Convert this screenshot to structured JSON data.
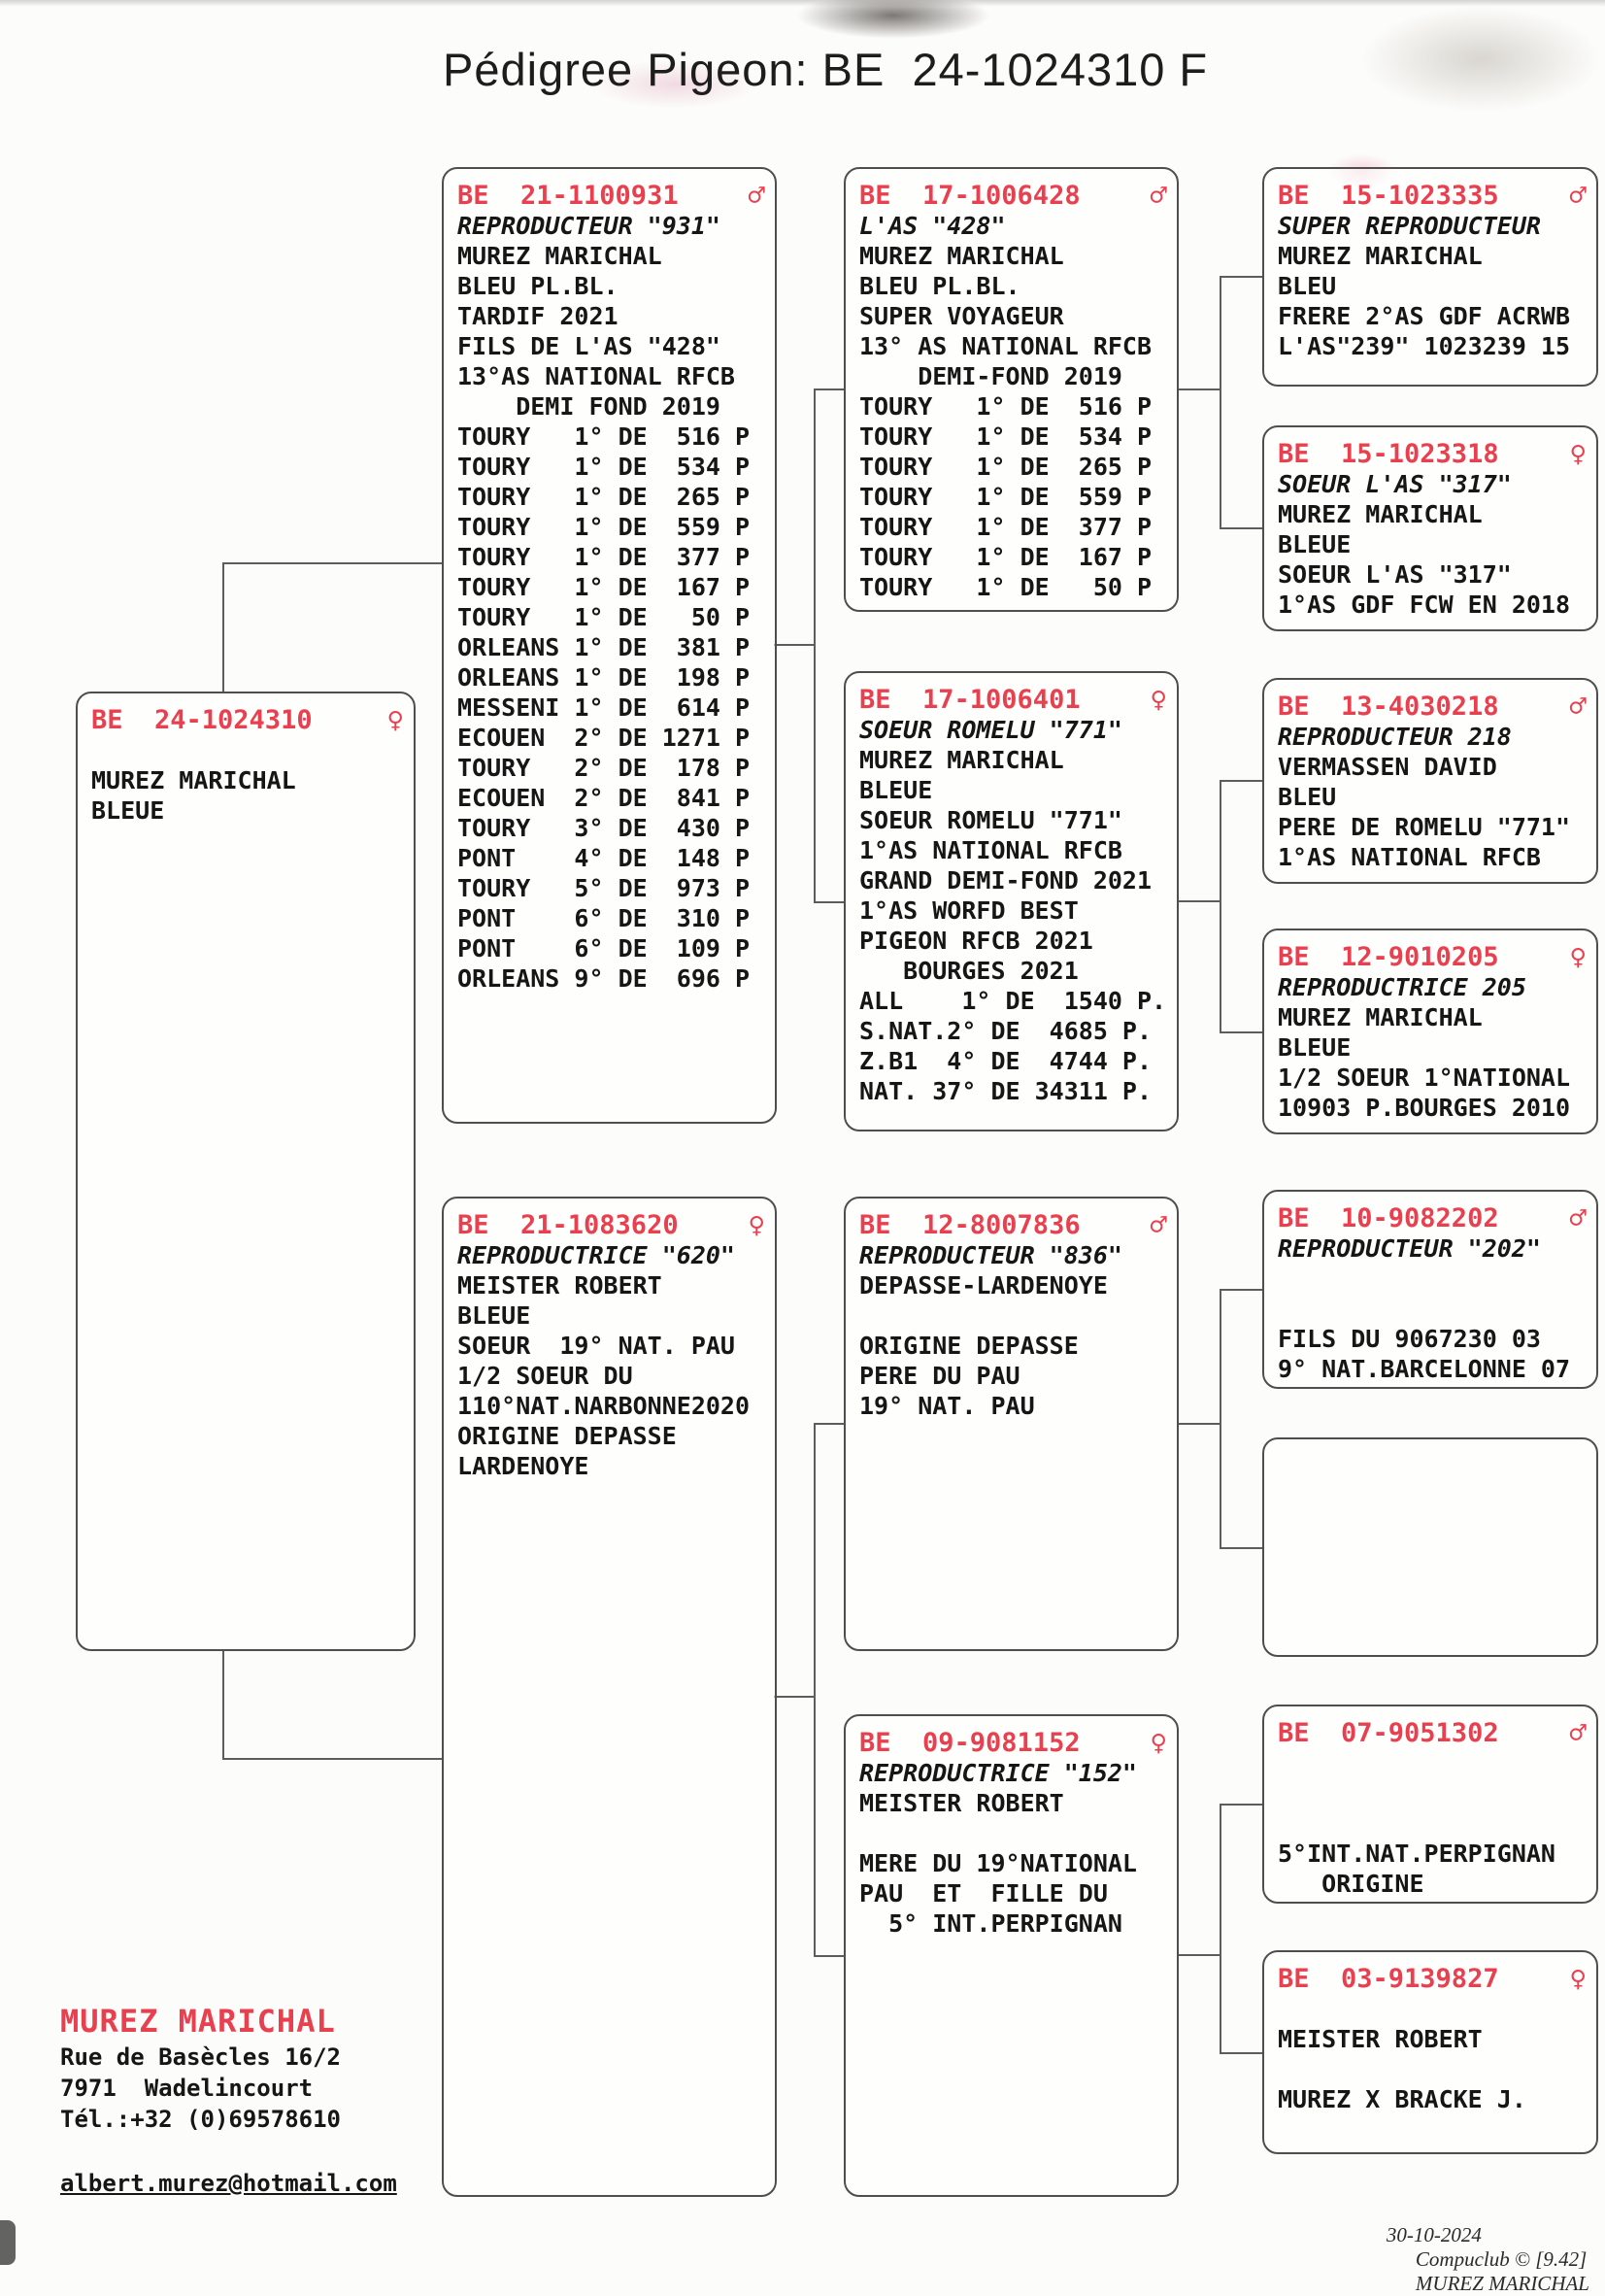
{
  "title": "Pédigree Pigeon: BE  24-1024310 F",
  "colors": {
    "accent_red": "#e9404f",
    "text": "#161616",
    "box_border": "#4e4e4e"
  },
  "boxes": {
    "subject": {
      "ring": "BE  24-1024310",
      "sex": "female",
      "sex_symbol": "♀",
      "lines": [
        "",
        "MUREZ MARICHAL",
        "BLEUE"
      ]
    },
    "sire": {
      "ring": "BE  21-1100931",
      "sex": "male",
      "sex_symbol": "♂",
      "name": "REPRODUCTEUR \"931\"",
      "lines": [
        "MUREZ MARICHAL",
        "BLEU PL.BL.",
        "TARDIF 2021",
        "FILS DE L'AS \"428\"",
        "13°AS NATIONAL RFCB",
        "    DEMI FOND 2019",
        "TOURY   1° DE  516 P",
        "TOURY   1° DE  534 P",
        "TOURY   1° DE  265 P",
        "TOURY   1° DE  559 P",
        "TOURY   1° DE  377 P",
        "TOURY   1° DE  167 P",
        "TOURY   1° DE   50 P",
        "ORLEANS 1° DE  381 P",
        "ORLEANS 1° DE  198 P",
        "MESSENI 1° DE  614 P",
        "ECOUEN  2° DE 1271 P",
        "TOURY   2° DE  178 P",
        "ECOUEN  2° DE  841 P",
        "TOURY   3° DE  430 P",
        "PONT    4° DE  148 P",
        "TOURY   5° DE  973 P",
        "PONT    6° DE  310 P",
        "PONT    6° DE  109 P",
        "ORLEANS 9° DE  696 P"
      ]
    },
    "dam": {
      "ring": "BE  21-1083620",
      "sex": "female",
      "sex_symbol": "♀",
      "name": "REPRODUCTRICE \"620\"",
      "lines": [
        "MEISTER ROBERT",
        "BLEUE",
        "SOEUR  19° NAT. PAU",
        "1/2 SOEUR DU",
        "110°NAT.NARBONNE2020",
        "ORIGINE DEPASSE",
        "LARDENOYE"
      ]
    },
    "sire_sire": {
      "ring": "BE  17-1006428",
      "sex": "male",
      "sex_symbol": "♂",
      "name": "L'AS \"428\"",
      "lines": [
        "MUREZ MARICHAL",
        "BLEU PL.BL.",
        "SUPER VOYAGEUR",
        "13° AS NATIONAL RFCB",
        "    DEMI-FOND 2019",
        "TOURY   1° DE  516 P",
        "TOURY   1° DE  534 P",
        "TOURY   1° DE  265 P",
        "TOURY   1° DE  559 P",
        "TOURY   1° DE  377 P",
        "TOURY   1° DE  167 P",
        "TOURY   1° DE   50 P"
      ]
    },
    "sire_dam": {
      "ring": "BE  17-1006401",
      "sex": "female",
      "sex_symbol": "♀",
      "name": "SOEUR ROMELU \"771\"",
      "lines": [
        "MUREZ MARICHAL",
        "BLEUE",
        "SOEUR ROMELU \"771\"",
        "1°AS NATIONAL RFCB",
        "GRAND DEMI-FOND 2021",
        "1°AS WORFD BEST",
        "PIGEON RFCB 2021",
        "   BOURGES 2021",
        "ALL    1° DE  1540 P.",
        "S.NAT.2° DE  4685 P.",
        "Z.B1  4° DE  4744 P.",
        "NAT. 37° DE 34311 P."
      ]
    },
    "dam_sire": {
      "ring": "BE  12-8007836",
      "sex": "male",
      "sex_symbol": "♂",
      "name": "REPRODUCTEUR \"836\"",
      "lines": [
        "DEPASSE-LARDENOYE",
        "",
        "ORIGINE DEPASSE",
        "PERE DU PAU",
        "19° NAT. PAU"
      ]
    },
    "dam_dam": {
      "ring": "BE  09-9081152",
      "sex": "female",
      "sex_symbol": "♀",
      "name": "REPRODUCTRICE \"152\"",
      "lines": [
        "MEISTER ROBERT",
        "",
        "MERE DU 19°NATIONAL",
        "PAU  ET  FILLE DU",
        "  5° INT.PERPIGNAN"
      ]
    },
    "ss_sire": {
      "ring": "BE  15-1023335",
      "sex": "male",
      "sex_symbol": "♂",
      "name": "SUPER REPRODUCTEUR",
      "lines": [
        "MUREZ MARICHAL",
        "BLEU",
        "FRERE 2°AS GDF ACRWB",
        "L'AS\"239\" 1023239 15"
      ]
    },
    "ss_dam": {
      "ring": "BE  15-1023318",
      "sex": "female",
      "sex_symbol": "♀",
      "name": "SOEUR L'AS \"317\"",
      "lines": [
        "MUREZ MARICHAL",
        "BLEUE",
        "SOEUR L'AS \"317\"",
        "1°AS GDF FCW EN 2018"
      ]
    },
    "sd_sire": {
      "ring": "BE  13-4030218",
      "sex": "male",
      "sex_symbol": "♂",
      "name": "REPRODUCTEUR 218",
      "lines": [
        "VERMASSEN DAVID",
        "BLEU",
        "PERE DE ROMELU \"771\"",
        "1°AS NATIONAL RFCB"
      ]
    },
    "sd_dam": {
      "ring": "BE  12-9010205",
      "sex": "female",
      "sex_symbol": "♀",
      "name": "REPRODUCTRICE 205",
      "lines": [
        "MUREZ MARICHAL",
        "BLEUE",
        "1/2 SOEUR 1°NATIONAL",
        "10903 P.BOURGES 2010"
      ]
    },
    "ds_sire": {
      "ring": "BE  10-9082202",
      "sex": "male",
      "sex_symbol": "♂",
      "name": "REPRODUCTEUR \"202\"",
      "lines": [
        "",
        "",
        "FILS DU 9067230 03",
        "9° NAT.BARCELONNE 07"
      ]
    },
    "dd_sire": {
      "ring": "BE  07-9051302",
      "sex": "male",
      "sex_symbol": "♂",
      "lines": [
        "",
        "",
        "",
        "5°INT.NAT.PERPIGNAN",
        "   ORIGINE"
      ]
    },
    "dd_dam": {
      "ring": "BE  03-9139827",
      "sex": "female",
      "sex_symbol": "♀",
      "lines": [
        "",
        "MEISTER ROBERT",
        "",
        "MUREZ X BRACKE J."
      ]
    }
  },
  "contact": {
    "name": "MUREZ MARICHAL",
    "address_line1": "Rue de Basècles 16/2",
    "address_line2": "7971  Wadelincourt",
    "phone": "Tél.:+32 (0)69578610",
    "email": "albert.murez@hotmail.com"
  },
  "footer": {
    "date": "30-10-2024",
    "software": "Compuclub © [9.42]",
    "owner": "MUREZ MARICHAL"
  }
}
